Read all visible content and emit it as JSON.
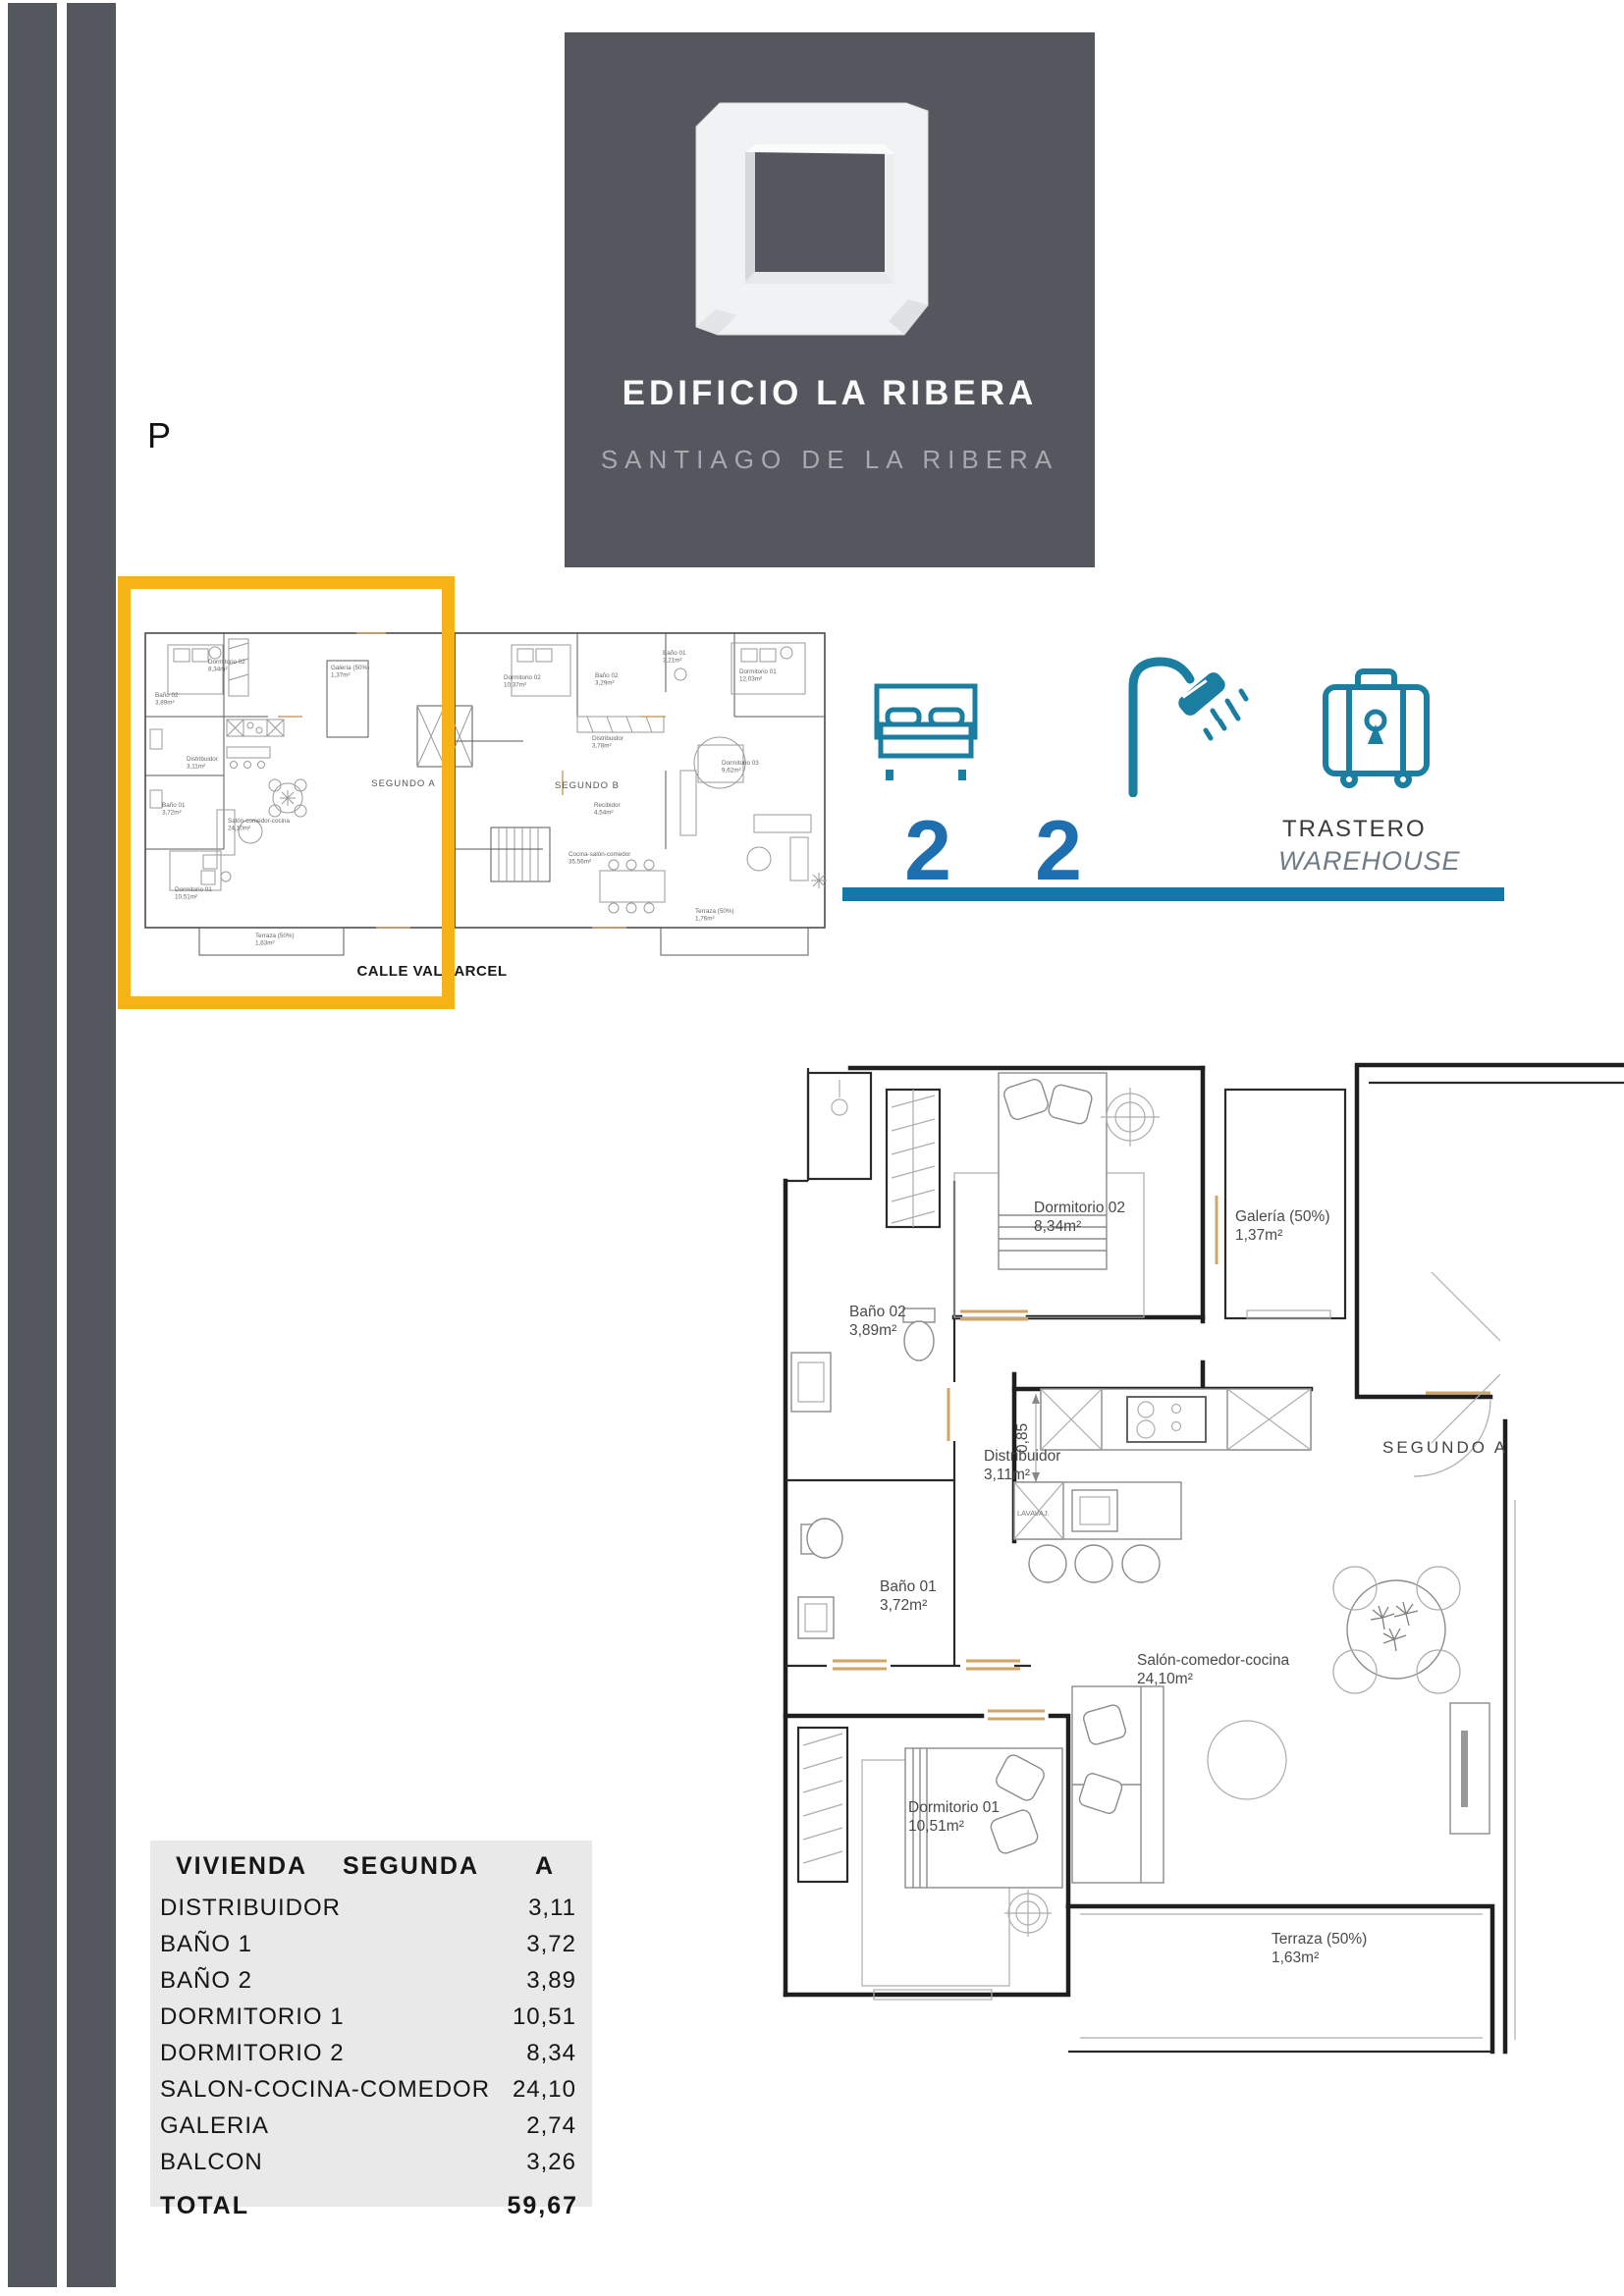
{
  "page": {
    "letter": "P"
  },
  "colors": {
    "brand_dark": "#54575E",
    "highlight_orange": "#F5B315",
    "icon_teal": "#1B7EA1",
    "number_blue": "#1D6FB0",
    "underline_blue": "#1278A9",
    "table_bg": "#E9E9E9"
  },
  "brand": {
    "title": "EDIFICIO LA RIBERA",
    "subtitle": "SANTIAGO DE LA RIBERA"
  },
  "features": {
    "bedrooms": "2",
    "bathrooms": "2",
    "storage_es": "TRASTERO",
    "storage_en": "WAREHOUSE"
  },
  "overview_plan": {
    "street": "CALLE VALCARCEL",
    "unit_a": {
      "label": "SEGUNDO A",
      "rooms": [
        {
          "name": "Dormitorio 02",
          "area": "8,34m²"
        },
        {
          "name": "Galería (50%)",
          "area": "1,37m²"
        },
        {
          "name": "Baño 02",
          "area": "3,89m²"
        },
        {
          "name": "Distribuidor",
          "area": "3,11m²"
        },
        {
          "name": "Baño 01",
          "area": "3,72m²"
        },
        {
          "name": "Salón-comedor-cocina",
          "area": "24,10m²"
        },
        {
          "name": "Dormitorio 01",
          "area": "10,51m²"
        },
        {
          "name": "Terraza (50%)",
          "area": "1,63m²"
        }
      ]
    },
    "unit_b": {
      "label": "SEGUNDO B",
      "rooms": [
        {
          "name": "Dormitorio 02",
          "area": "10,37m²"
        },
        {
          "name": "Baño 02",
          "area": "3,29m²"
        },
        {
          "name": "Baño 01",
          "area": "3,21m²"
        },
        {
          "name": "Dormitorio 01",
          "area": "12,03m²"
        },
        {
          "name": "Distribuidor",
          "area": "3,78m²"
        },
        {
          "name": "Dormitorio 03",
          "area": "9,62m²"
        },
        {
          "name": "Recibidor",
          "area": "4,54m²"
        },
        {
          "name": "Cocina-salón-comedor",
          "area": "35,56m²"
        },
        {
          "name": "Terraza (50%)",
          "area": "1,76m²"
        }
      ]
    }
  },
  "detail_plan": {
    "unit_label": "SEGUNDO A",
    "dimension": "0,85",
    "appliance": "LAVAVAJ.",
    "rooms": [
      {
        "name": "Dormitorio 02",
        "area": "8,34m²"
      },
      {
        "name": "Galería (50%)",
        "area": "1,37m²"
      },
      {
        "name": "Baño 02",
        "area": "3,89m²"
      },
      {
        "name": "Distribuidor",
        "area": "3,11m²"
      },
      {
        "name": "Baño 01",
        "area": "3,72m²"
      },
      {
        "name": "Salón-comedor-cocina",
        "area": "24,10m²"
      },
      {
        "name": "Dormitorio 01",
        "area": "10,51m²"
      },
      {
        "name": "Terraza (50%)",
        "area": "1,63m²"
      }
    ]
  },
  "area_table": {
    "header": {
      "col1": "VIVIENDA",
      "col2": "SEGUNDA",
      "col3": "A"
    },
    "rows": [
      {
        "label": "DISTRIBUIDOR",
        "value": "3,11"
      },
      {
        "label": "BAÑO 1",
        "value": "3,72"
      },
      {
        "label": "BAÑO 2",
        "value": "3,89"
      },
      {
        "label": "DORMITORIO 1",
        "value": "10,51"
      },
      {
        "label": "DORMITORIO 2",
        "value": "8,34"
      },
      {
        "label": "SALON-COCINA-COMEDOR",
        "value": "24,10"
      },
      {
        "label": "GALERIA",
        "value": "2,74"
      },
      {
        "label": "BALCON",
        "value": "3,26"
      }
    ],
    "total": {
      "label": "TOTAL",
      "value": "59,67"
    }
  }
}
